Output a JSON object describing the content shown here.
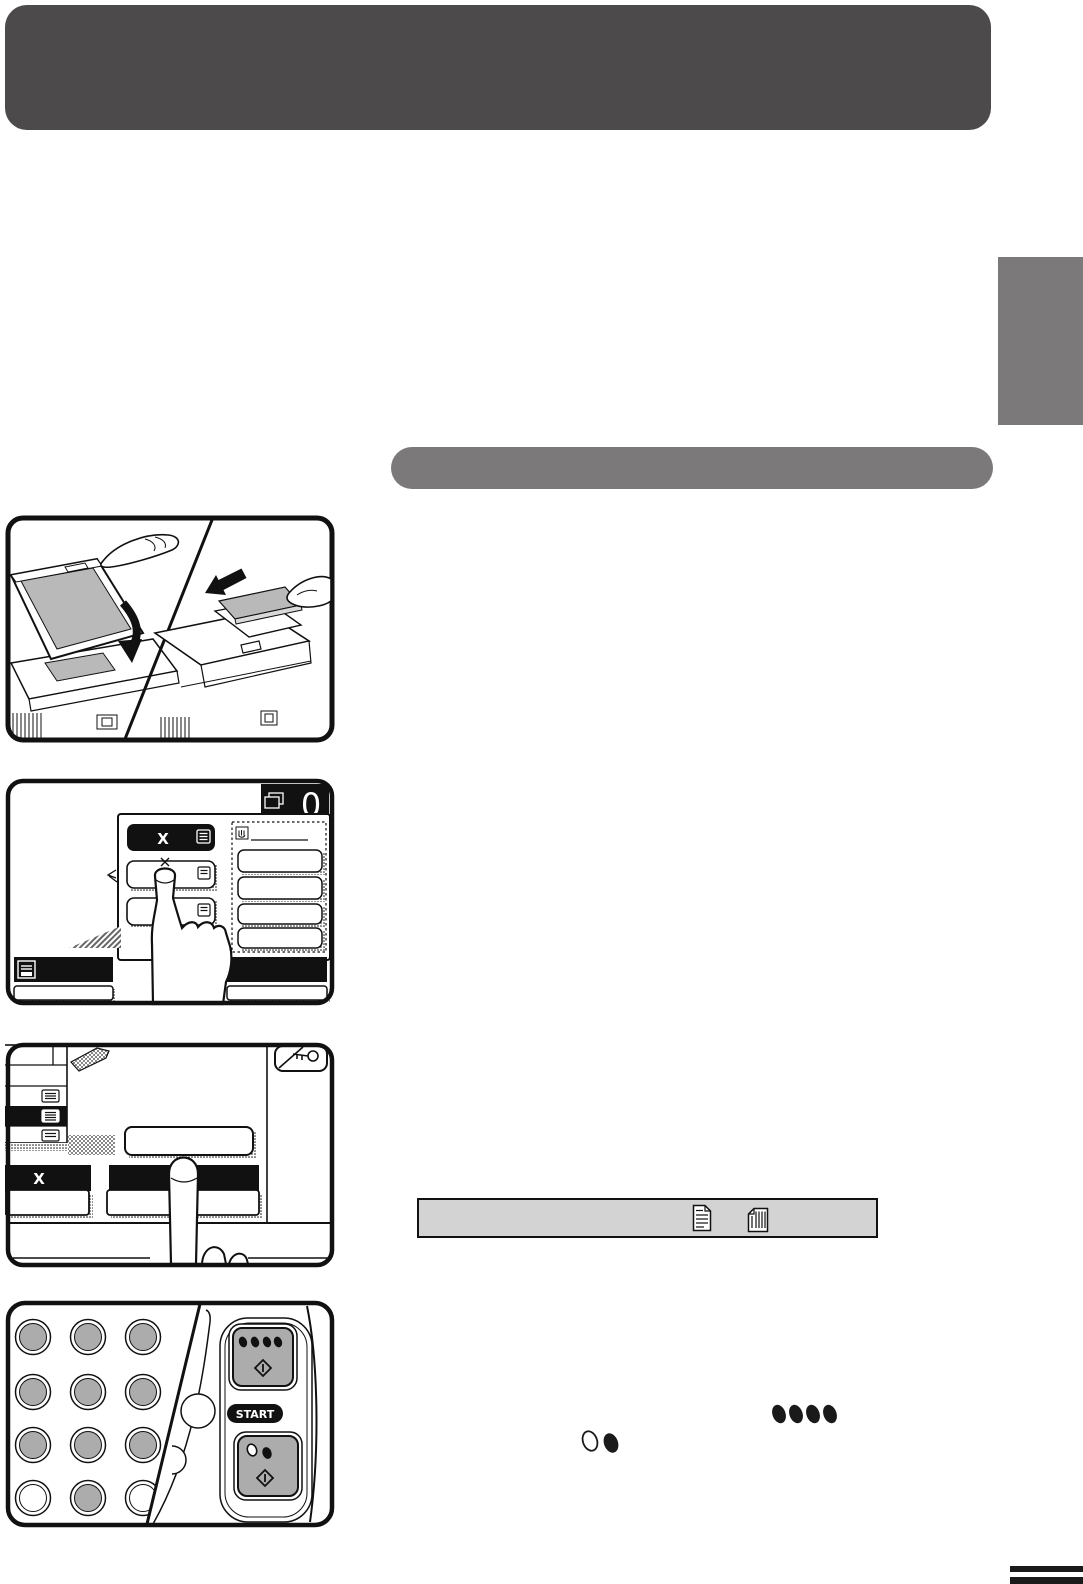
{
  "meta": {
    "kind": "copier-operation-manual-page"
  },
  "colors": {
    "top_banner": "#4d4a4b",
    "section_banner": "#7b7979",
    "side_tab": "#7b7979",
    "notice_bar_bg": "#d3d3d3",
    "key_face_gray": "#acacac",
    "illustration_gray": "#b9b9b9"
  },
  "banners": {
    "top_text": "",
    "section_text": ""
  },
  "step2": {
    "counter_value": "0",
    "zoom_key": "X"
  },
  "step3": {
    "zoom_key": "X"
  },
  "step4": {
    "start_label": "START"
  },
  "icons": {
    "counter": "copy-pages-icon",
    "step2_list": "menu-list-icon",
    "step2_hand": "touch-hand-icon",
    "step2_tray": "paper-tray-icon",
    "step3_key": "key-icon",
    "step3_interrupt": "interrupt-key-icon",
    "notice_left": "original-portrait-icon",
    "notice_right": "original-rotated-icon",
    "color_start": "color-start-dots-icon",
    "bw_start": "bw-start-dots-icon",
    "start_diamond": "start-diamond-icon"
  }
}
